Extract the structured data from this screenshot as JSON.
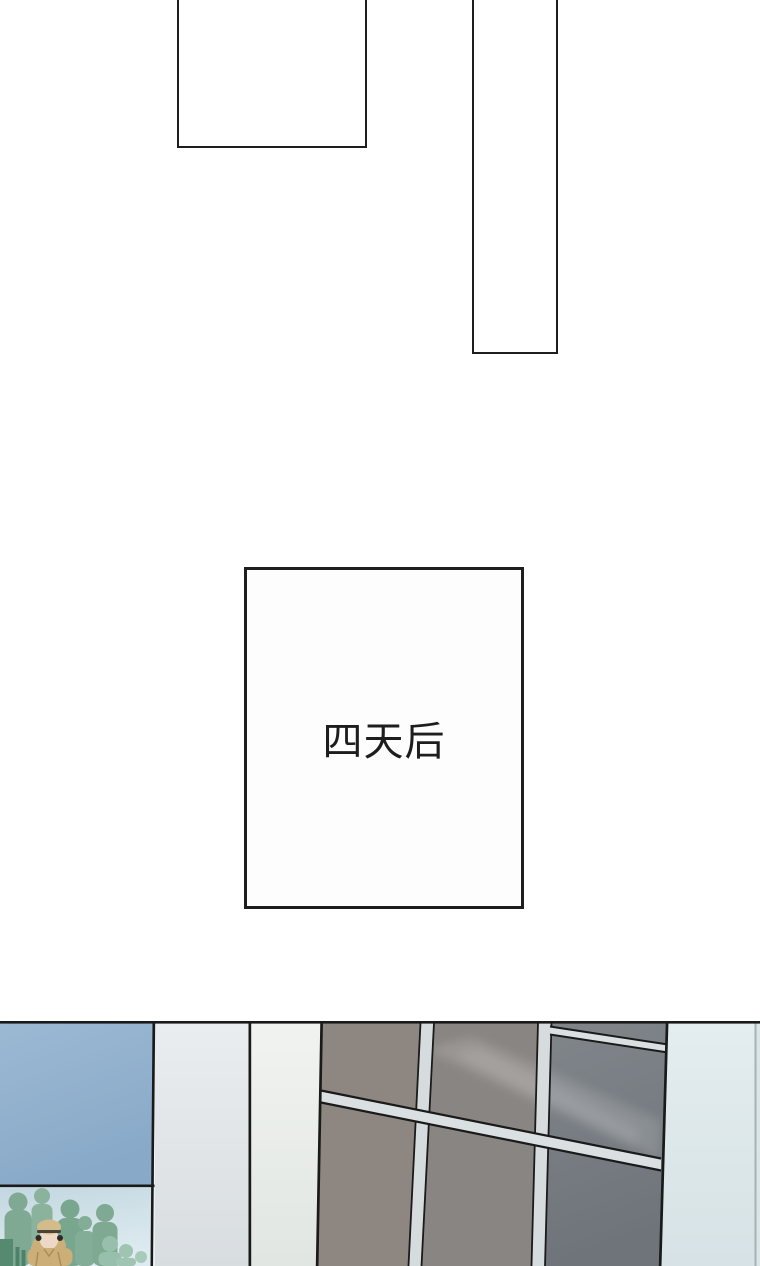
{
  "page": {
    "background": "#ffffff"
  },
  "caption": {
    "text": "四天后"
  },
  "colors": {
    "line_black": "#1a1a1a",
    "panel_border": "#1e1e1e",
    "blue_top": "#9cb9d3",
    "blue_bottom": "#88a9c8",
    "col1_top": "#eaedef",
    "col1_bottom": "#d8dde0",
    "col2_top": "#f1f3f0",
    "col2_bottom": "#e1e6e2",
    "colR_top": "#e4edef",
    "colR_bottom": "#d6e2e5",
    "sliver": "#dae5e8",
    "sliver_divider": "#a3b3b8",
    "panel_a": "#8e8781",
    "panel_b": "#898582",
    "panel_c_top": "#81868b",
    "panel_c_bottom": "#6e747a",
    "mullion": "#d6dcde",
    "diag_bar": "#dae0e2",
    "crowd_top": "#c3d7e0",
    "crowd_bottom": "#dcebef",
    "silhouette_a": "#7fa992",
    "silhouette_b": "#8bb29d",
    "silhouette_c": "#79a68f",
    "silhouette_d": "#84ad98",
    "silhouette_e": "#97bfab",
    "silhouette_f": "#9fc4b1",
    "silhouette_g": "#a8cab8",
    "silhouette_dark": "#568a70",
    "silhouette_dark2": "#4e8268",
    "coat": "#ccae78",
    "hat": "#d4bc8a",
    "face": "#ecd8c5",
    "hat_brim": "#48423a",
    "headphone": "#2e2a27",
    "coat_line": "#a98e58",
    "reflection": "#ffffff"
  }
}
